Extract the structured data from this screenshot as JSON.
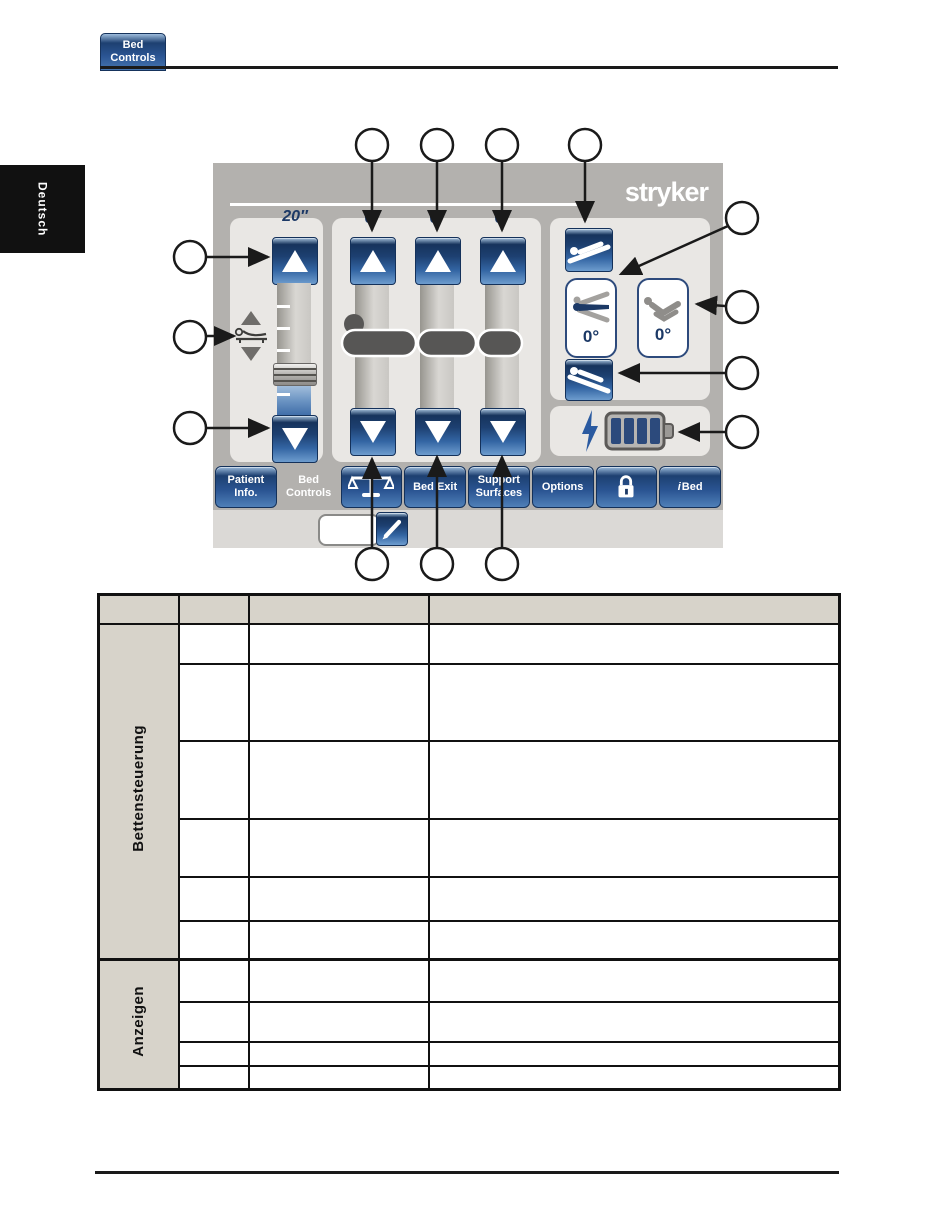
{
  "header": {
    "tab_label": "Bed\nControls"
  },
  "sidebar": {
    "language_tab": "Deutsch"
  },
  "screen": {
    "brand": "stryker",
    "height_control": {
      "value": "20″"
    },
    "columns": [
      {
        "angle": "0°"
      },
      {
        "angle": "0°"
      },
      {
        "angle": "0°"
      }
    ],
    "indicators": {
      "bed_angle": "0°",
      "knee_angle": "0°"
    },
    "tabbar": {
      "patient_info": "Patient\nInfo.",
      "bed_controls": "Bed\nControls",
      "bed_exit": "Bed Exit",
      "support_surfaces": "Support\nSurfaces",
      "options": "Options",
      "ibed_prefix": "i",
      "ibed_label": "Bed"
    },
    "note_field_value": "",
    "icons": {
      "tabbar_scale": "balance-scale",
      "tabbar_lock": "padlock",
      "edit": "pencil",
      "battery": "battery-4-bars",
      "charging": "lightning-bolt",
      "height_adjust": "bed-height-up-down",
      "incline_head_up": "bed-incline-head-up",
      "incline_head_down": "bed-incline-head-down",
      "bed_angle": "head-of-bed-angle",
      "knee_angle": "knee-gatch-angle",
      "patient": "patient-lying-figure"
    }
  },
  "table": {
    "group1": {
      "label": "Bettensteuerung"
    },
    "group2": {
      "label": "Anzeigen"
    }
  },
  "colors": {
    "button_blue_dark": "#1d4071",
    "button_blue_light": "#6d9cce",
    "panel_gray": "#b3b1ae",
    "subpanel_gray": "#e9e7e4",
    "table_header_gray": "#d7d3ca",
    "navy_text": "#1c3966",
    "battery_bar_navy": "#2c4a7c"
  }
}
